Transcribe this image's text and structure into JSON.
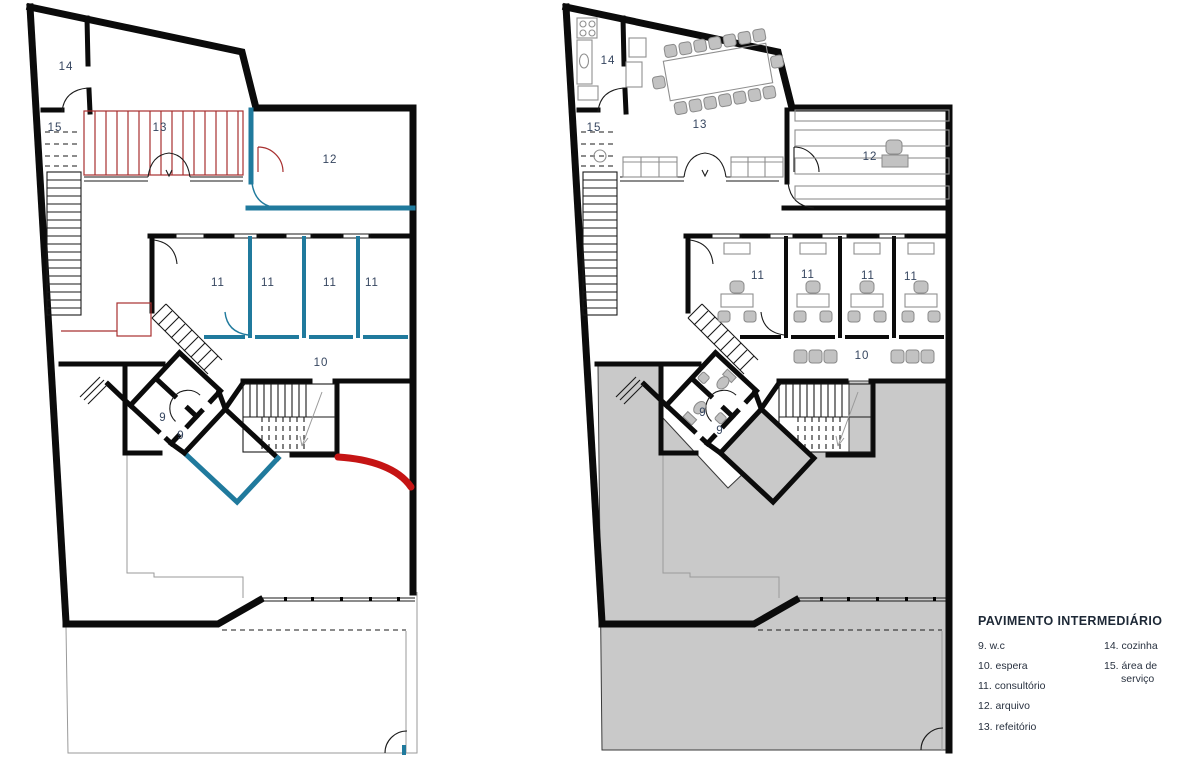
{
  "plan": {
    "rooms": {
      "wc": "9",
      "espera": "10",
      "consultorio": "11",
      "arquivo": "12",
      "refeitorio": "13",
      "cozinha": "14",
      "area_servico": "15"
    }
  },
  "legend": {
    "title": "PAVIMENTO INTERMEDIÁRIO",
    "col1": [
      "9. w.c",
      "10. espera",
      "11. consultório",
      "12. arquivo",
      "13. refeitório"
    ],
    "col2_item1": "14. cozinha",
    "col2_item2_line1": "15. área de",
    "col2_item2_line2": "serviço"
  },
  "colors": {
    "wall_black": "#0b0b0b",
    "highlight_teal": "#207a9d",
    "highlight_red": "#c51414",
    "hatch_red": "#a83030",
    "floor_gray": "#c9c9c9",
    "label_navy": "#35455f"
  }
}
